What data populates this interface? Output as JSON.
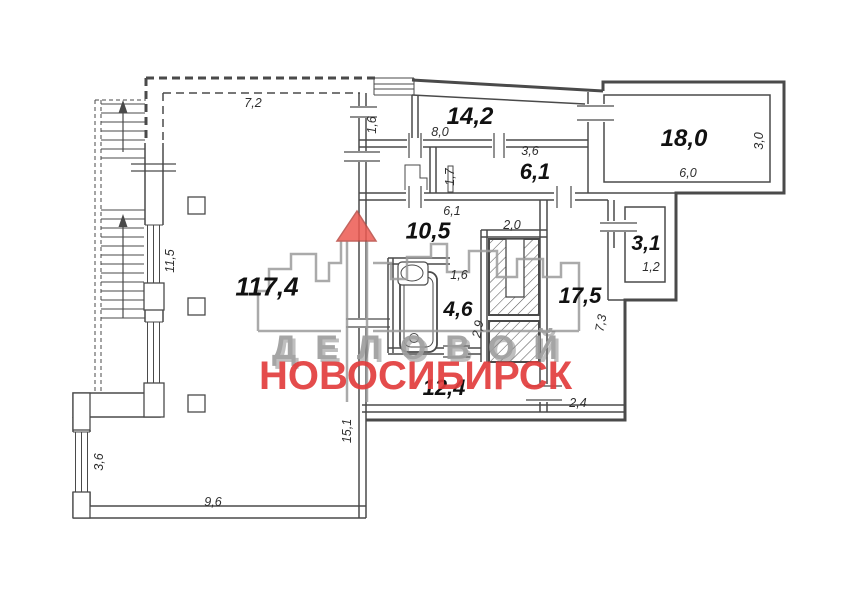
{
  "watermark": {
    "line1": "ДЕЛОВОЙ",
    "line2": "НОВОСИБИРСК",
    "accent_red": "#e23d3d",
    "accent_gray": "#9e9e9e"
  },
  "rooms": [
    {
      "name": "main-hall",
      "area": "117,4"
    },
    {
      "name": "corridor-top",
      "area": "14,2"
    },
    {
      "name": "room-6-1",
      "area": "6,1"
    },
    {
      "name": "room-18-0",
      "area": "18,0"
    },
    {
      "name": "room-10-5",
      "area": "10,5"
    },
    {
      "name": "room-3-1",
      "area": "3,1"
    },
    {
      "name": "room-17-5",
      "area": "17,5"
    },
    {
      "name": "bathroom",
      "area": "4,6"
    },
    {
      "name": "room-12-4",
      "area": "12,4"
    }
  ],
  "dims": [
    {
      "name": "top-wall-length",
      "text": "7,2"
    },
    {
      "name": "nook-width",
      "text": "1,6"
    },
    {
      "name": "corridor-length",
      "text": "8,0"
    },
    {
      "name": "room-6-1-width",
      "text": "3,6"
    },
    {
      "name": "room-6-1-depth",
      "text": "1,7"
    },
    {
      "name": "room-18-0-depth",
      "text": "3,0"
    },
    {
      "name": "room-18-0-width",
      "text": "6,0"
    },
    {
      "name": "room-10-5-width",
      "text": "6,1"
    },
    {
      "name": "shaft-nook-width",
      "text": "2,0"
    },
    {
      "name": "bathroom-width",
      "text": "1,6"
    },
    {
      "name": "bathroom-depth",
      "text": "2,9"
    },
    {
      "name": "room-3-1-width",
      "text": "1,2"
    },
    {
      "name": "room-17-5-depth",
      "text": "7,3"
    },
    {
      "name": "corridor-2-4-width",
      "text": "2,4"
    },
    {
      "name": "stair-wall-length",
      "text": "11,5"
    },
    {
      "name": "hall-wall-length",
      "text": "15,1"
    },
    {
      "name": "left-window-length",
      "text": "3,6"
    },
    {
      "name": "bottom-wall-length",
      "text": "9,6"
    }
  ]
}
